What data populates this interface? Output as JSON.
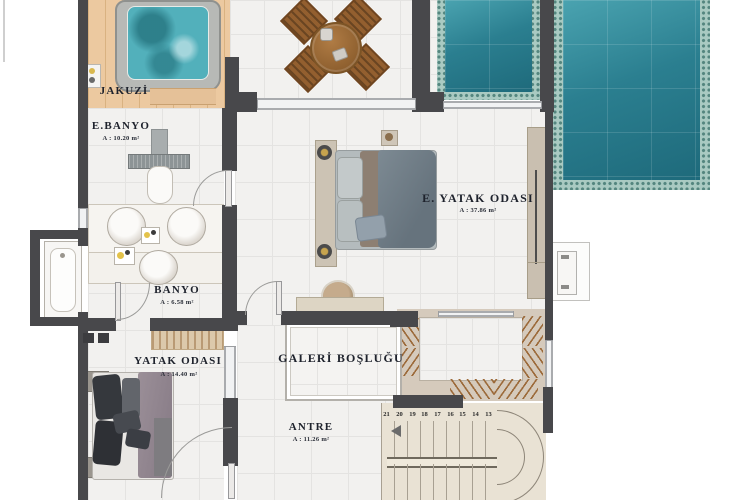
{
  "plan": {
    "rooms": {
      "jakuzi": {
        "label": "JAKUZİ"
      },
      "e_banyo": {
        "label": "E.BANYO",
        "area": "A : 10.20 m²"
      },
      "e_yatak_odasi": {
        "label": "E. YATAK ODASI",
        "area": "A : 37.86 m²"
      },
      "banyo": {
        "label": "BANYO",
        "area": "A : 6.58 m²"
      },
      "yatak_odasi": {
        "label": "YATAK ODASI",
        "area": "A : 14.40 m²"
      },
      "galeri": {
        "label": "GALERİ BOŞLUĞU"
      },
      "antre": {
        "label": "ANTRE",
        "area": "A : 11.26 m²"
      }
    },
    "stairs": {
      "step_numbers": [
        "21",
        "20",
        "19",
        "18",
        "17",
        "16",
        "15",
        "14",
        "13"
      ]
    },
    "colors": {
      "pool_water": "#2b7f90",
      "mosaic_border": "#a9cac2",
      "wall": "#48484b",
      "wood_deck": "#ecc9a0",
      "marble_tile": "#f2f1ef",
      "closet_hatch": "#9c6a3a",
      "label_text": "#1e222c",
      "stair_floor": "#e9e2d4"
    }
  }
}
